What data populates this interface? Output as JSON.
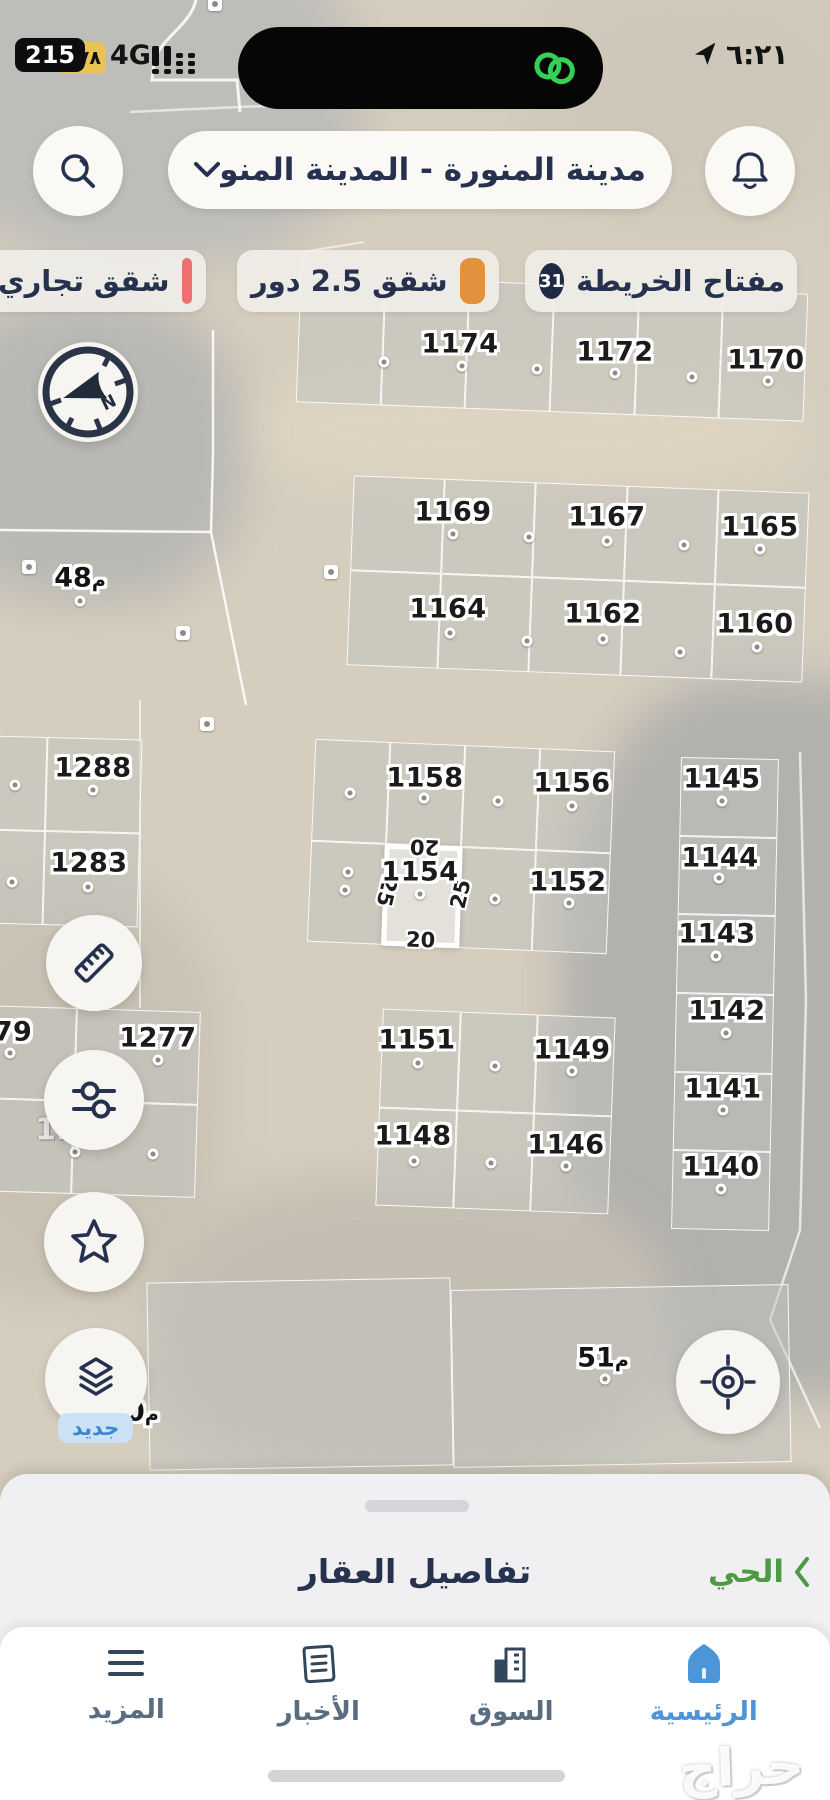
{
  "colors": {
    "accent_navy": "#25314e",
    "legend_orange": "#e2913d",
    "legend_red": "#ee7170",
    "active_blue": "#4c95d8",
    "inactive_gray": "#5a6c80",
    "green_link": "#4e9a44",
    "island_green": "#35d156",
    "battery_yellow": "#e9c353"
  },
  "status_bar": {
    "app_badge": "215",
    "battery_percent": "٧٨",
    "network": "4G",
    "time": "٦:٢١",
    "icons": [
      "signal-bars-icon",
      "link-icon",
      "location-arrow-icon"
    ]
  },
  "header": {
    "search_icon": "magnifier",
    "bell_icon": "notification-bell",
    "location_selector": "مدينة المنورة - المدينة المنور"
  },
  "legend": {
    "key_chip": {
      "label": "مفتاح الخريطة",
      "count": "31"
    },
    "chips": [
      {
        "label": "شقق 2.5 دور",
        "color": "#e2913d"
      },
      {
        "label": "شقق تجاري",
        "color": "#ee7170"
      }
    ]
  },
  "map": {
    "compass": "N",
    "selected_plot": {
      "label": "1154",
      "dim_top": "20",
      "dim_left": "25",
      "dim_right": "25",
      "dim_bottom": "20"
    },
    "plots": [
      {
        "label": "1174",
        "x": 460,
        "y": 344,
        "dot": [
          462,
          366
        ]
      },
      {
        "label": "1172",
        "x": 615,
        "y": 352,
        "dot": [
          615,
          373
        ]
      },
      {
        "label": "1170",
        "x": 766,
        "y": 360,
        "dot": [
          768,
          381
        ]
      },
      {
        "label": "1169",
        "x": 453,
        "y": 512,
        "dot": [
          453,
          534
        ]
      },
      {
        "label": "1167",
        "x": 607,
        "y": 517,
        "dot": [
          607,
          541
        ]
      },
      {
        "label": "1165",
        "x": 760,
        "y": 527,
        "dot": [
          760,
          549
        ]
      },
      {
        "label": "1164",
        "x": 448,
        "y": 609,
        "dot": [
          450,
          633
        ]
      },
      {
        "label": "1162",
        "x": 603,
        "y": 614,
        "dot": [
          603,
          639
        ]
      },
      {
        "label": "1160",
        "x": 755,
        "y": 624,
        "dot": [
          757,
          647
        ]
      },
      {
        "label": "1288",
        "x": 93,
        "y": 768,
        "dot": [
          93,
          790
        ]
      },
      {
        "label": "1283",
        "x": 89,
        "y": 863,
        "dot": [
          88,
          887
        ]
      },
      {
        "label": "1158",
        "x": 425,
        "y": 778,
        "dot": [
          424,
          798
        ]
      },
      {
        "label": "1156",
        "x": 572,
        "y": 783,
        "dot": [
          572,
          806
        ]
      },
      {
        "label": "1154",
        "x": 420,
        "y": 872,
        "dot": [
          420,
          894
        ]
      },
      {
        "label": "1152",
        "x": 568,
        "y": 882,
        "dot": [
          569,
          903
        ]
      },
      {
        "label": "1145",
        "x": 722,
        "y": 779,
        "dot": [
          722,
          801
        ]
      },
      {
        "label": "1144",
        "x": 720,
        "y": 858,
        "dot": [
          719,
          878
        ]
      },
      {
        "label": "1143",
        "x": 717,
        "y": 934,
        "dot": [
          716,
          956
        ]
      },
      {
        "label": "1142",
        "x": 727,
        "y": 1011,
        "dot": [
          726,
          1033
        ]
      },
      {
        "label": "1141",
        "x": 723,
        "y": 1089,
        "dot": [
          723,
          1110
        ]
      },
      {
        "label": "1140",
        "x": 721,
        "y": 1167,
        "dot": [
          721,
          1189
        ]
      },
      {
        "label": "79",
        "x": 13,
        "y": 1032,
        "dot": [
          10,
          1053
        ]
      },
      {
        "label": "1277",
        "x": 158,
        "y": 1038,
        "dot": [
          158,
          1060
        ]
      },
      {
        "label": "1151",
        "x": 417,
        "y": 1040,
        "dot": [
          418,
          1063
        ]
      },
      {
        "label": "1149",
        "x": 572,
        "y": 1050,
        "dot": [
          572,
          1071
        ]
      },
      {
        "label": "1148",
        "x": 413,
        "y": 1136,
        "dot": [
          414,
          1161
        ]
      },
      {
        "label": "1146",
        "x": 566,
        "y": 1145,
        "dot": [
          566,
          1166
        ]
      }
    ],
    "free_dots": [
      [
        384,
        362
      ],
      [
        537,
        369
      ],
      [
        692,
        377
      ],
      [
        529,
        537
      ],
      [
        684,
        545
      ],
      [
        527,
        641
      ],
      [
        680,
        652
      ],
      [
        15,
        785
      ],
      [
        12,
        882
      ],
      [
        350,
        793
      ],
      [
        498,
        801
      ],
      [
        348,
        872
      ],
      [
        345,
        890
      ],
      [
        495,
        899
      ],
      [
        495,
        1066
      ],
      [
        491,
        1163
      ],
      [
        75,
        1152
      ],
      [
        153,
        1154
      ]
    ],
    "ghost_labels": [
      {
        "text": "1272",
        "x": 77,
        "y": 1130
      }
    ],
    "measure_labels": [
      {
        "text": "48",
        "unit": "م",
        "x": 80,
        "y": 578,
        "dot": [
          80,
          601
        ]
      },
      {
        "text": "51",
        "unit": "م",
        "x": 603,
        "y": 1358,
        "dot": [
          605,
          1379
        ]
      },
      {
        "text": "50",
        "unit": "م",
        "x": 133,
        "y": 1412
      }
    ],
    "square_markers": [
      [
        215,
        4
      ],
      [
        29,
        567
      ],
      [
        207,
        724
      ],
      [
        331,
        572
      ],
      [
        183,
        633
      ]
    ],
    "new_badge": "جديد"
  },
  "bottom_sheet": {
    "title": "تفاصيل العقار",
    "neighborhood_link": "الحي"
  },
  "bottom_nav": {
    "items": [
      {
        "label": "الرئيسية",
        "icon": "home",
        "active": true
      },
      {
        "label": "السوق",
        "icon": "market-buildings",
        "active": false
      },
      {
        "label": "الأخبار",
        "icon": "newspaper",
        "active": false
      },
      {
        "label": "المزيد",
        "icon": "more-menu",
        "active": false
      }
    ]
  },
  "watermark": "حراج"
}
